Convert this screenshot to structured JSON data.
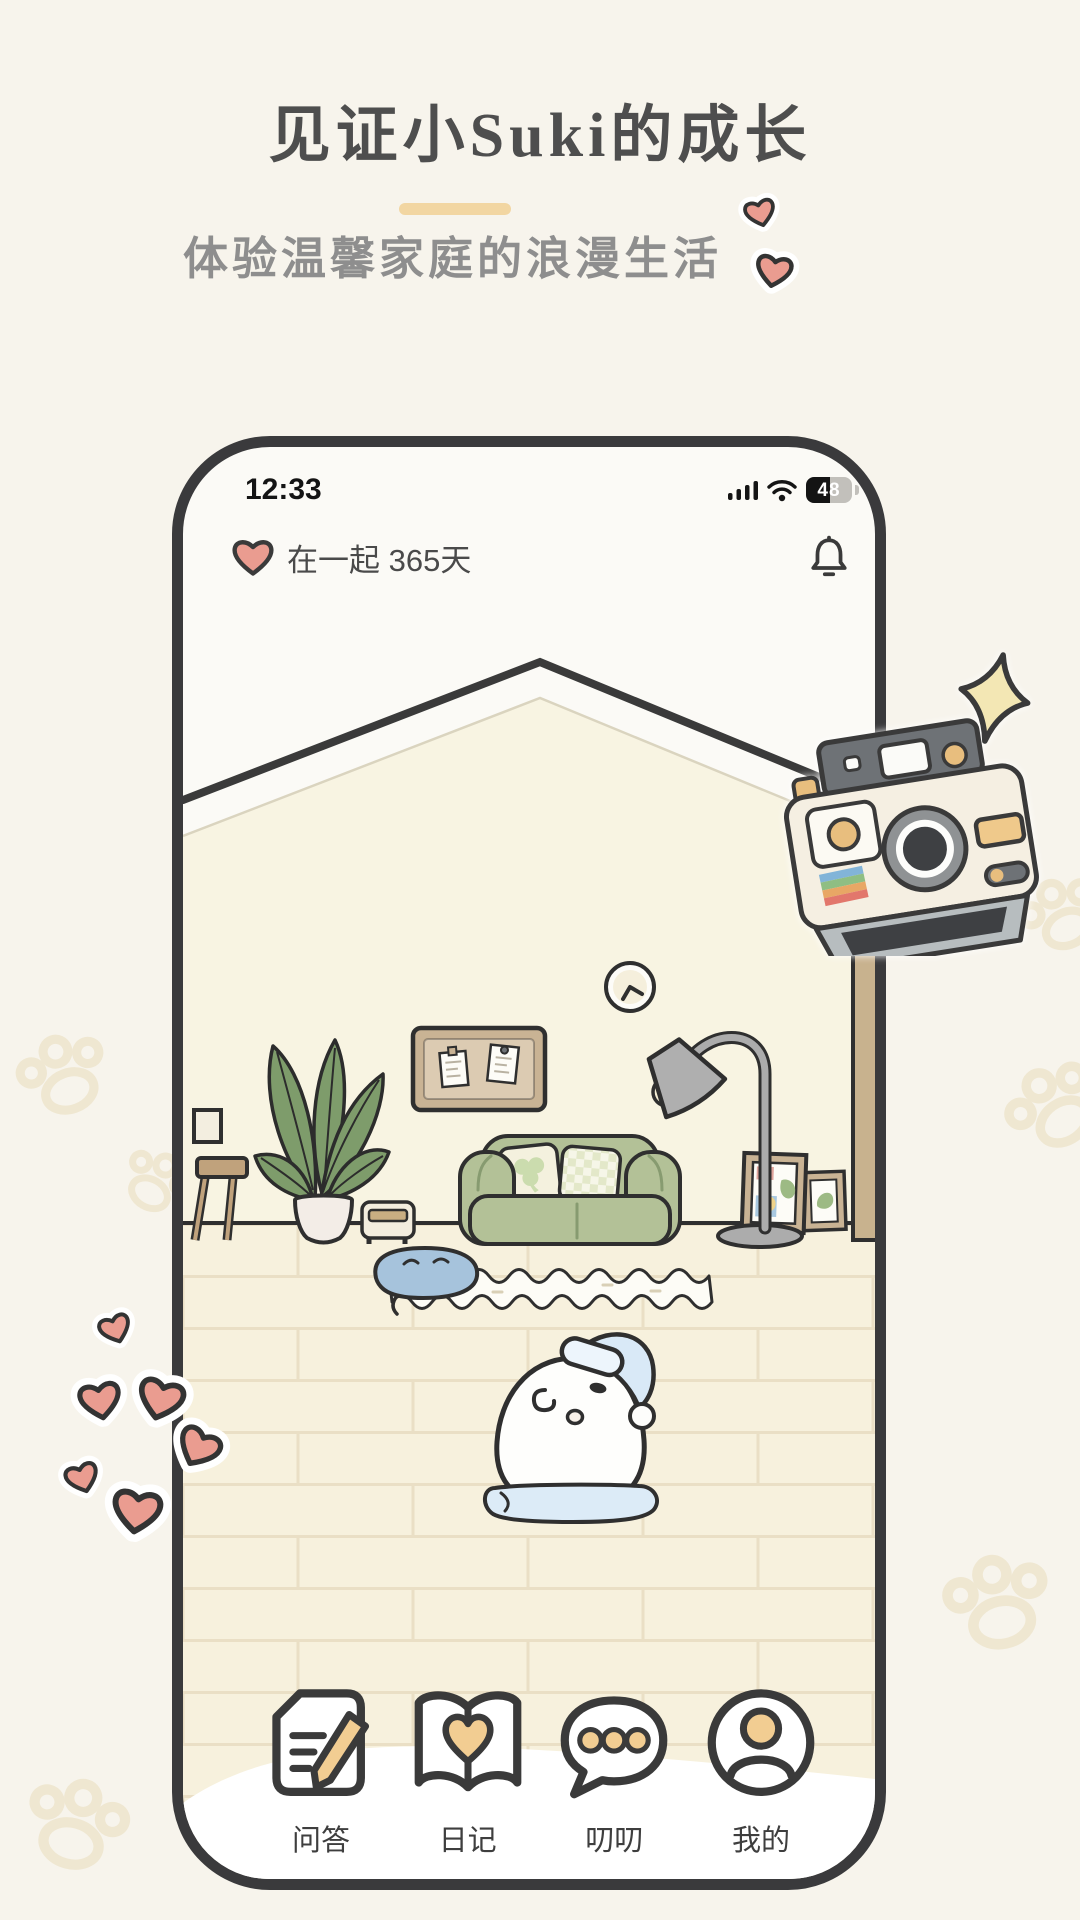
{
  "page": {
    "title": "见证小Suki的成长",
    "subtitle": "体验温馨家庭的浪漫生活",
    "underline_color": "#F2D6A2",
    "background_color": "#F7F4EC",
    "heart_sticker_color": "#EA9C90"
  },
  "phone": {
    "status_bar": {
      "time": "12:33",
      "battery": "48"
    },
    "header": {
      "relationship_label": "在一起 365天"
    },
    "nav": {
      "items": [
        {
          "label": "问答",
          "icon": "qa-paper-pencil-icon"
        },
        {
          "label": "日记",
          "icon": "diary-book-heart-icon"
        },
        {
          "label": "叨叨",
          "icon": "chat-bubble-icon"
        },
        {
          "label": "我的",
          "icon": "profile-icon"
        }
      ]
    },
    "scene_icons": [
      "roof-gable",
      "pinboard",
      "wall-clock",
      "potted-plant",
      "desk-with-mirror",
      "toaster",
      "green-sofa",
      "floor-lamp",
      "picture-frames",
      "door",
      "rug",
      "sleeping-pet",
      "pet-character-with-nightcap",
      "cushion"
    ],
    "colors": {
      "outline": "#2F2F2F",
      "wall": "#F8F4E2",
      "floor": "#F7F1DD",
      "sofa_green": "#B3C197",
      "wood_tan": "#C8B28E",
      "hat_blue": "#D9E9F7",
      "nav_accent_tan": "#F2CD92"
    }
  }
}
